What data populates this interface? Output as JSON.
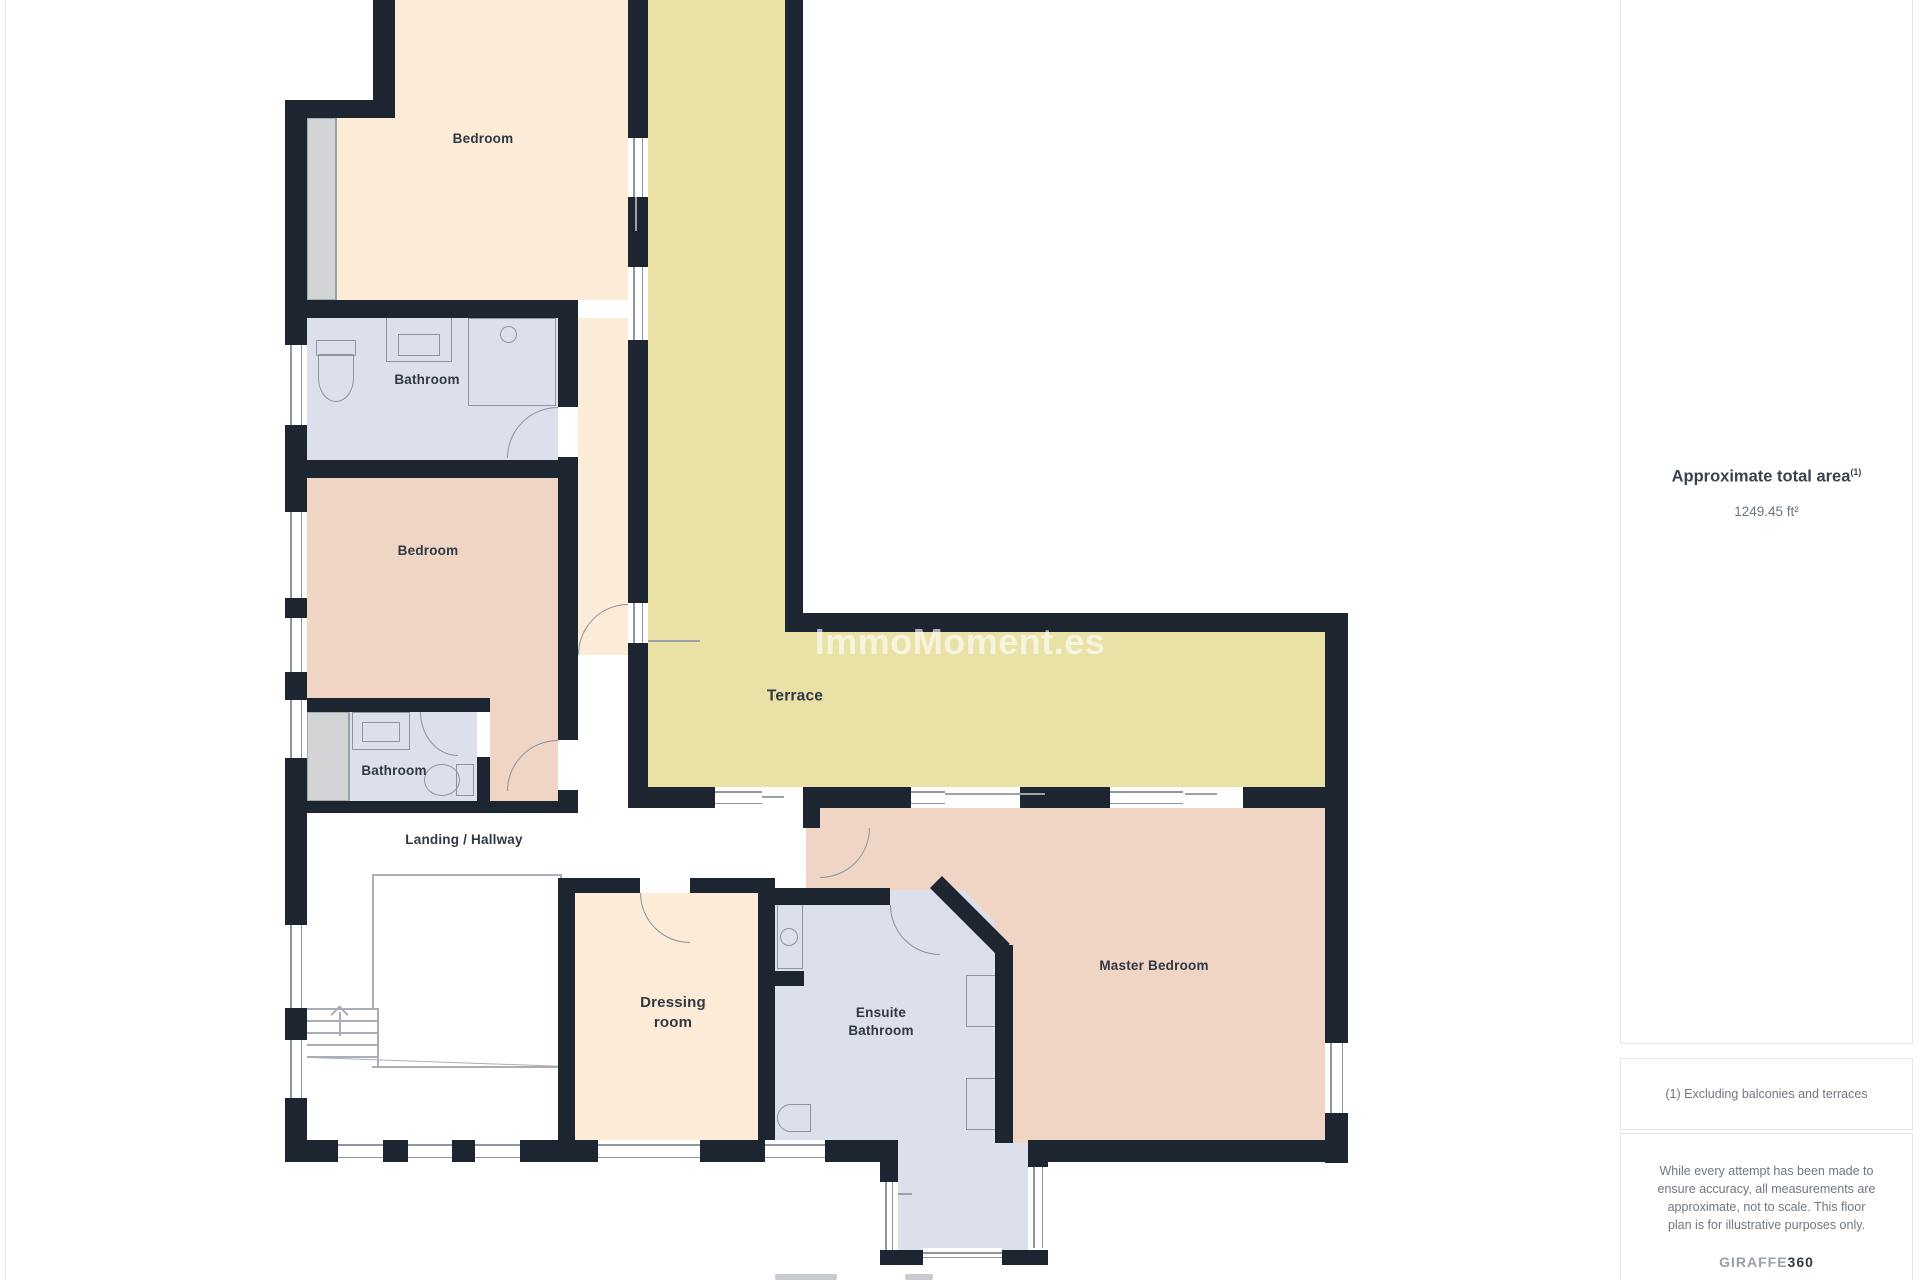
{
  "floorplan": {
    "rooms": [
      {
        "id": "bedroom-1",
        "label": "Bedroom"
      },
      {
        "id": "bathroom-1",
        "label": "Bathroom"
      },
      {
        "id": "bedroom-2",
        "label": "Bedroom"
      },
      {
        "id": "bathroom-2",
        "label": "Bathroom"
      },
      {
        "id": "landing",
        "label": "Landing / Hallway"
      },
      {
        "id": "terrace",
        "label": "Terrace"
      },
      {
        "id": "dressing-room",
        "label": "Dressing\nroom"
      },
      {
        "id": "ensuite-bathroom",
        "label": "Ensuite\nBathroom"
      },
      {
        "id": "master-bedroom",
        "label": "Master Bedroom"
      }
    ],
    "watermark": "ImmoMoment.es",
    "colors": {
      "wall": "#1c2530",
      "bedroom_cream": "#fcebd6",
      "bedroom_pink": "#f0d5c4",
      "bathroom_blue": "#dbe0ec",
      "terrace_yellow": "#e9e1a6",
      "wardrobe_gray": "#d2d4d6"
    }
  },
  "sidebar": {
    "area_heading": "Approximate total area",
    "area_heading_superscript": "(1)",
    "area_value": "1249.45 ft²",
    "footnote": "(1) Excluding balconies and terraces",
    "disclaimer_lines": [
      "While every attempt has been made to",
      "ensure accuracy, all measurements are",
      "approximate, not to scale. This floor",
      "plan is for illustrative purposes only."
    ],
    "brand_giraffe": "GIRAFFE",
    "brand_360": "360"
  }
}
